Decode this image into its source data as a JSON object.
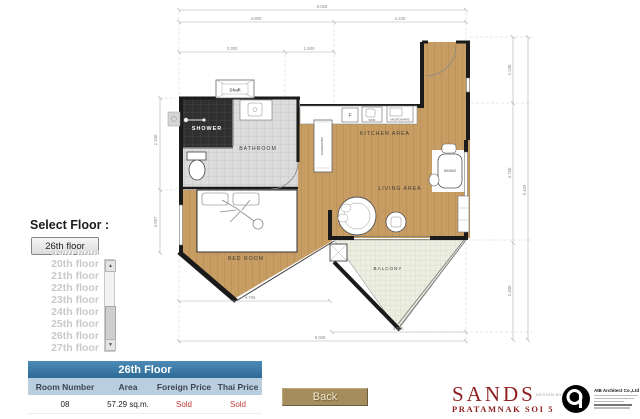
{
  "floor_selector": {
    "label": "Select Floor :",
    "selected": "26th floor",
    "options": [
      "19th floor",
      "20th floor",
      "21th floor",
      "22th floor",
      "23th floor",
      "24th floor",
      "25th floor",
      "26th floor",
      "27th floor"
    ]
  },
  "table": {
    "title": "26th Floor",
    "columns": [
      "Room Number",
      "Area",
      "Foreign Price",
      "Thai Price"
    ],
    "row": {
      "room": "08",
      "area": "57.29 sq.m.",
      "foreign_price": "Sold",
      "thai_price": "Sold"
    }
  },
  "back_button": "Back",
  "branding": {
    "name": "SANDS",
    "subtitle": "PRATAMNAK SOI 5",
    "design_by": "DESIGN BY",
    "company": "AIB Architect Co.,Ltd"
  },
  "plan": {
    "rooms": {
      "shower": "SHOWER",
      "bathroom": "BATHROOM",
      "kitchen": "KITCHEN AREA",
      "living": "LIVING AREA",
      "dining": "DINING",
      "bedroom": "BED ROOM",
      "balcony": "BALCONY",
      "shaft": "Shaft",
      "wardrobe": "WARDROBE",
      "fridge": "F",
      "sink": "SINK",
      "microwave": "MICROWAVE"
    },
    "dims": {
      "top_total": "9.025",
      "top_left": "4.800",
      "top_right": "4.225",
      "mid_left": "3.300",
      "mid_right": "1.500",
      "right_top": "2.230",
      "right_mid": "4.750",
      "right_bottom": "2.400",
      "right_total": "9.429",
      "bottom_bedroom": "4.706",
      "bottom_balcony": "4.325",
      "bottom_total": "9.025",
      "left_upper": "2.100",
      "left_lower": "4.597"
    },
    "colors": {
      "wood": "#c79d63",
      "wall": "#1a1a1a",
      "tile": "#dedede",
      "dark_tile": "#303030",
      "balcony_tile": "#eceee2"
    }
  },
  "ui_colors": {
    "table_header": "#3f7ca9",
    "table_subheader": "#b9cfe0",
    "sold_red": "#c23b3b",
    "back_button": "#a58d5e",
    "brand_red": "#8e1d1d"
  }
}
